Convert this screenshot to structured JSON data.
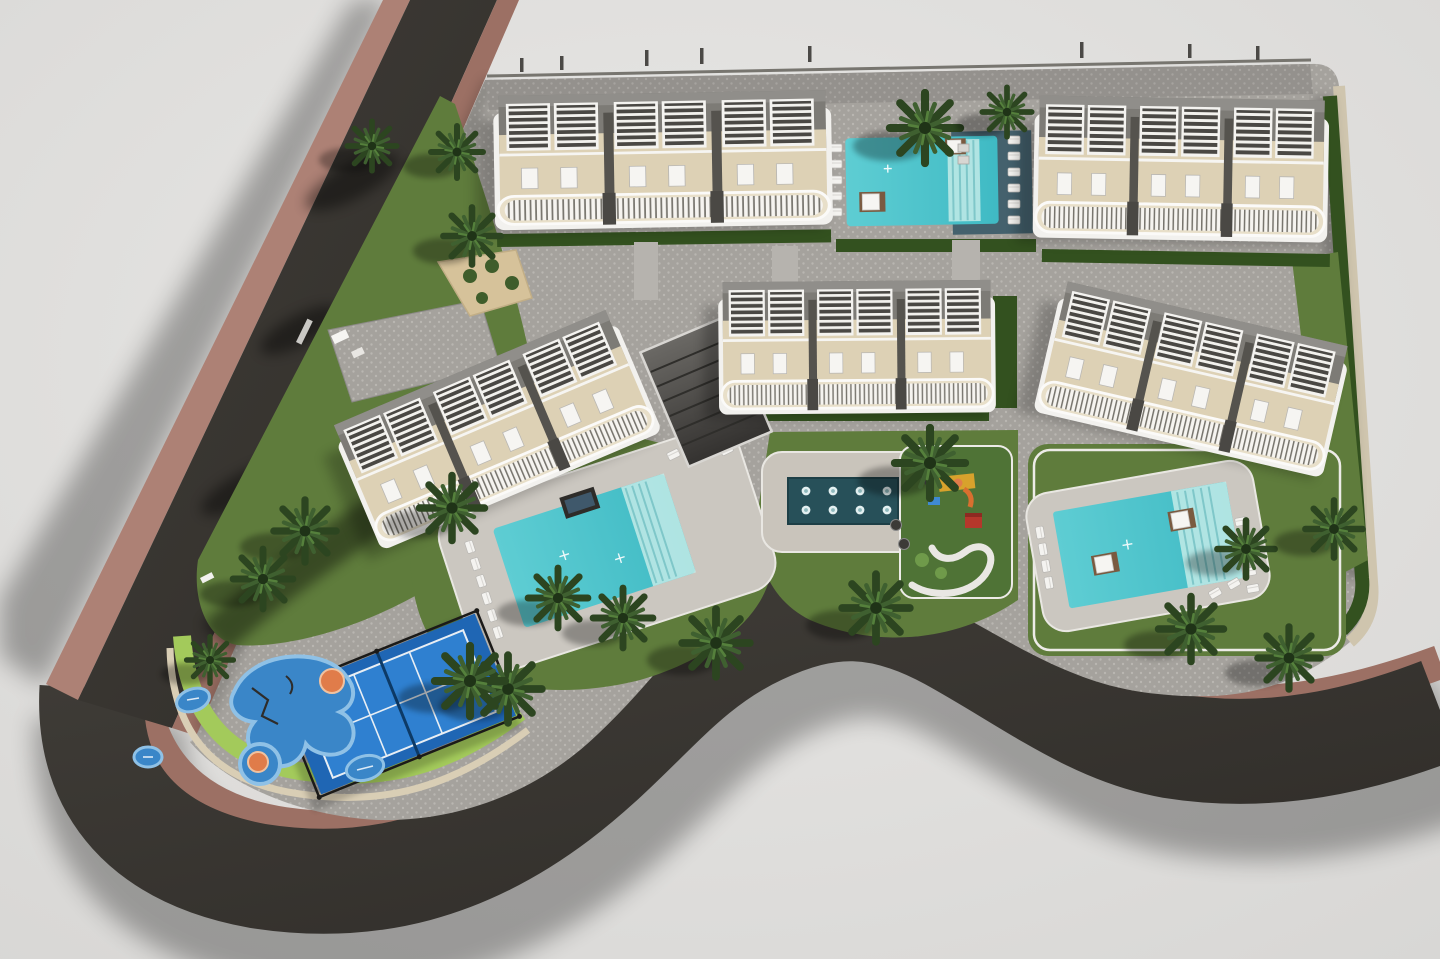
{
  "meta": {
    "type": "aerial-3d-site-plan-render",
    "view": "top-down",
    "subject": "residential complex master plan"
  },
  "palette": {
    "bg": "#e9e8e6",
    "bgEdge": "#d7d6d4",
    "road": "#302d29",
    "roadLight": "#403d38",
    "sidewalk": "#9c7064",
    "sidewalkLight": "#ad8175",
    "curb": "#d9ceb5",
    "tanStrip": "#cfc5ae",
    "lawn": "#5f7c3c",
    "lawnBright": "#a3ca5b",
    "lawnDark": "#4f7336",
    "hedge": "#33511f",
    "paver": "#a5a29d",
    "paverDot": "#b9b6b1",
    "walk": "#b6b3ae",
    "deck": "#cbc7c0",
    "pool": "#5ecdd3",
    "poolDeep": "#3fbac4",
    "poolShallow": "#c3ebe8",
    "navyDeck": "#44616d",
    "spa": "#275059",
    "building": "#ddd1b5",
    "buildingWhite": "#f2f1ee",
    "balcony": "#e8dfc9",
    "roof": "#7d7b76",
    "roofLight": "#908e8a",
    "divider": "#55534e",
    "pergolaDark": "#4a4844",
    "court": "#2f80d0",
    "courtDark": "#1f66b4",
    "splash": "#3a86c8",
    "splashRing": "#8fc1e6",
    "orange": "#e07c4a",
    "red": "#b5372b",
    "yellow": "#d8a22c",
    "platform": "#7a5a40",
    "white": "#f6f5f2",
    "sand": "#d6c29a",
    "palmDark": "#2c4520",
    "palmMid": "#3f6030",
    "palmLight": "#55803c"
  },
  "scene": {
    "buildings": 5,
    "building_style": "3-module townhouse blocks with white pergola roofs and scalloped balconies",
    "swimming_pools": 3,
    "jet_pool_jets": 8,
    "paddle_courts": 1,
    "playgrounds": 1,
    "kids_splash_pads": 1,
    "palm_trees": 20,
    "sun_loungers": 32,
    "daybeds": 4
  }
}
